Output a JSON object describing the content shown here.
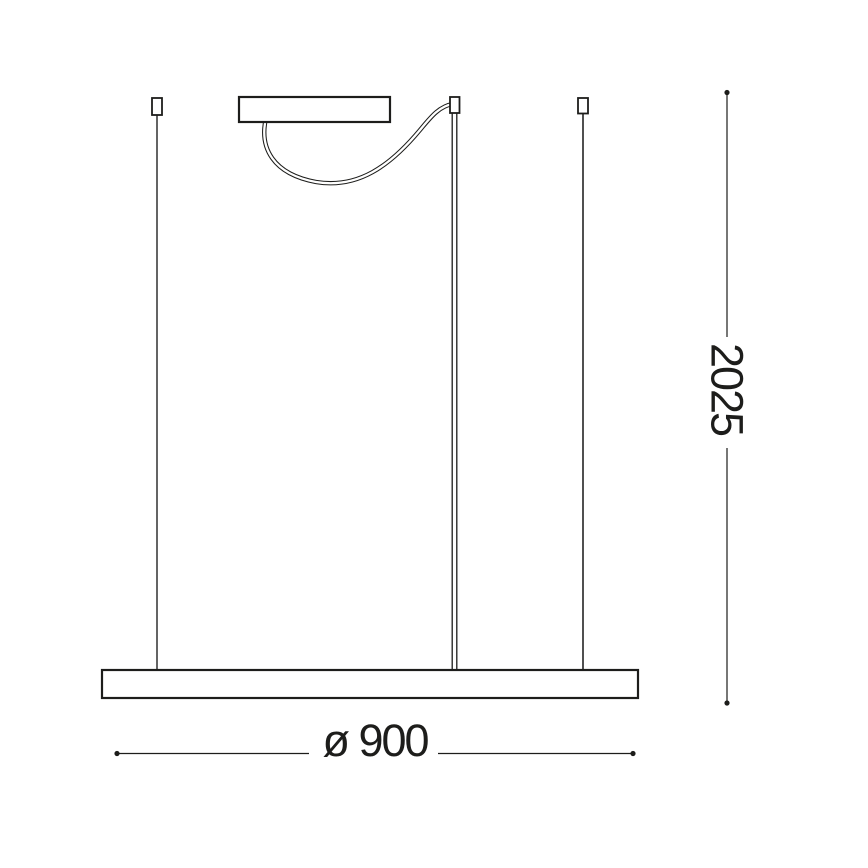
{
  "colors": {
    "line": "#1d1d1b",
    "wire": "#3d3d3d",
    "dim": "#1d1d1b",
    "background": "#ffffff"
  },
  "dimensions": {
    "height": {
      "label": "2025"
    },
    "diameter": {
      "label": "ø 900"
    }
  }
}
